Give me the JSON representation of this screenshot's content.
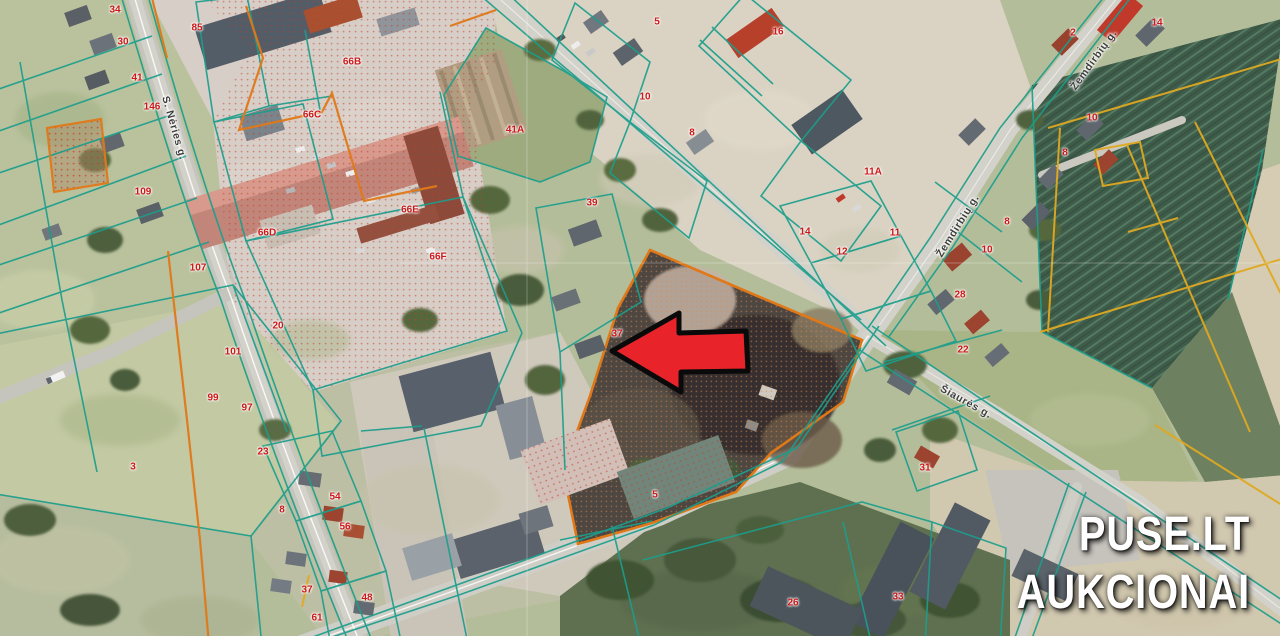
{
  "branding": {
    "line1": "PUSE.LT",
    "line2": "AUKCIONAI"
  },
  "map": {
    "type": "aerial-cadastre-map",
    "marker": {
      "shape": "left-arrow",
      "tip_x": 612,
      "tip_y": 351
    },
    "street_labels": [
      {
        "text": "S. Nėries g.",
        "x": 174,
        "y": 128,
        "rot": 74
      },
      {
        "text": "Žemdirbių g.",
        "x": 1094,
        "y": 60,
        "rot": -54
      },
      {
        "text": "Žemdirbių g.",
        "x": 958,
        "y": 226,
        "rot": -58
      },
      {
        "text": "Šiaurės g.",
        "x": 966,
        "y": 402,
        "rot": 29
      }
    ],
    "parcel_numbers": [
      {
        "text": "34",
        "x": 115,
        "y": 10
      },
      {
        "text": "85",
        "x": 197,
        "y": 28
      },
      {
        "text": "30",
        "x": 123,
        "y": 42
      },
      {
        "text": "41",
        "x": 137,
        "y": 78
      },
      {
        "text": "146",
        "x": 152,
        "y": 107
      },
      {
        "text": "109",
        "x": 143,
        "y": 192
      },
      {
        "text": "66B",
        "x": 352,
        "y": 62
      },
      {
        "text": "66C",
        "x": 312,
        "y": 115
      },
      {
        "text": "66D",
        "x": 267,
        "y": 233
      },
      {
        "text": "66E",
        "x": 410,
        "y": 210
      },
      {
        "text": "66F",
        "x": 438,
        "y": 257
      },
      {
        "text": "41A",
        "x": 515,
        "y": 130
      },
      {
        "text": "5",
        "x": 657,
        "y": 22
      },
      {
        "text": "10",
        "x": 645,
        "y": 97
      },
      {
        "text": "8",
        "x": 692,
        "y": 133
      },
      {
        "text": "16",
        "x": 778,
        "y": 32
      },
      {
        "text": "11A",
        "x": 873,
        "y": 172
      },
      {
        "text": "2",
        "x": 1073,
        "y": 33
      },
      {
        "text": "14",
        "x": 1157,
        "y": 23
      },
      {
        "text": "10",
        "x": 1092,
        "y": 118
      },
      {
        "text": "8",
        "x": 1065,
        "y": 153
      },
      {
        "text": "14",
        "x": 805,
        "y": 232
      },
      {
        "text": "12",
        "x": 842,
        "y": 252
      },
      {
        "text": "11",
        "x": 895,
        "y": 233
      },
      {
        "text": "10",
        "x": 987,
        "y": 250
      },
      {
        "text": "8",
        "x": 1007,
        "y": 222
      },
      {
        "text": "28",
        "x": 960,
        "y": 295
      },
      {
        "text": "22",
        "x": 963,
        "y": 350
      },
      {
        "text": "107",
        "x": 198,
        "y": 268
      },
      {
        "text": "20",
        "x": 278,
        "y": 326
      },
      {
        "text": "101",
        "x": 233,
        "y": 352
      },
      {
        "text": "99",
        "x": 213,
        "y": 398
      },
      {
        "text": "97",
        "x": 247,
        "y": 408
      },
      {
        "text": "23",
        "x": 263,
        "y": 452
      },
      {
        "text": "39",
        "x": 592,
        "y": 203
      },
      {
        "text": "37",
        "x": 617,
        "y": 334
      },
      {
        "text": "3",
        "x": 133,
        "y": 467
      },
      {
        "text": "54",
        "x": 335,
        "y": 497
      },
      {
        "text": "56",
        "x": 345,
        "y": 527
      },
      {
        "text": "8",
        "x": 282,
        "y": 510
      },
      {
        "text": "37",
        "x": 307,
        "y": 590
      },
      {
        "text": "61",
        "x": 317,
        "y": 618
      },
      {
        "text": "48",
        "x": 367,
        "y": 598
      },
      {
        "text": "31",
        "x": 925,
        "y": 468
      },
      {
        "text": "5",
        "x": 655,
        "y": 495
      },
      {
        "text": "26",
        "x": 793,
        "y": 603
      },
      {
        "text": "33",
        "x": 898,
        "y": 597
      }
    ]
  },
  "colors": {
    "boundary_teal": "#1c9e8c",
    "boundary_orange": "#e07818",
    "boundary_yellow": "#dfa921",
    "parcel_number_red": "#cc1818",
    "street_label_gray": "#3d3d3d",
    "arrow_red": "#e8242a",
    "brand_white": "#ffffff"
  }
}
